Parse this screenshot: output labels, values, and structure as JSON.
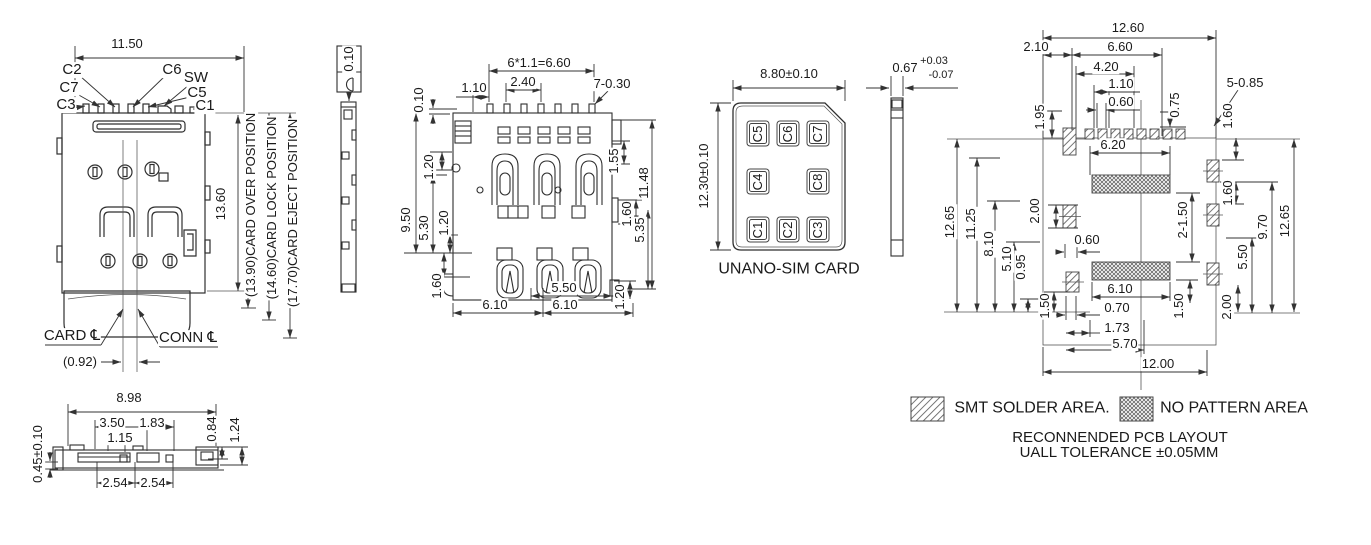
{
  "front": {
    "dim_width": "11.50",
    "dim_height": "13.60",
    "pins": [
      "C2",
      "C7",
      "C3",
      "C6",
      "SW",
      "C5",
      "C1"
    ],
    "positions": [
      "(13.90)CARD OVER POSITION",
      "(14.60)CARD LOCK POSITION",
      "(17.70)CARD EJECT POSITION"
    ],
    "card_cl": "CARD ℄",
    "conn_cl": "CONN ℄",
    "center_offset": "(0.92)"
  },
  "side": {
    "width": "8.98",
    "d_350": "3.50",
    "d_183": "1.83",
    "d_115": "1.15",
    "d_084": "0.84",
    "d_124": "1.24",
    "height_tol": "0.45±0.10",
    "pitch_a": "2.54",
    "pitch_b": "2.54"
  },
  "edge": {
    "profile_tol": "0.10"
  },
  "top": {
    "pin_pitch": "6*1.1=6.60",
    "d_110": "1.10",
    "d_240": "2.40",
    "d_730": "7-0.30",
    "d_010": "0.10",
    "d_120a": "1.20",
    "d_950": "9.50",
    "d_530": "5.30",
    "d_120b": "1.20",
    "d_160a": "1.60",
    "d_550": "5.50",
    "d_610a": "6.10",
    "d_610b": "6.10",
    "d_155": "1.55",
    "d_1148": "11.48",
    "d_160b": "1.60",
    "d_535": "5.35",
    "d_120c": "1.20"
  },
  "sim": {
    "dim_width": "8.80±0.10",
    "dim_height": "12.30±0.10",
    "caption": "UNANO-SIM CARD",
    "pads": [
      "C5",
      "C6",
      "C7",
      "C4",
      "C8",
      "C1",
      "C2",
      "C3"
    ]
  },
  "card_edge": {
    "thickness": "0.67",
    "tol_plus": "+0.03",
    "tol_minus": "-0.07"
  },
  "pcb": {
    "d_1260": "12.60",
    "d_210": "2.10",
    "d_660": "6.60",
    "d_420": "4.20",
    "d_110": "1.10",
    "d_060a": "0.60",
    "d_075": "0.75",
    "d_5085": "5-0.85",
    "d_195": "1.95",
    "d_160a": "1.60",
    "d_620": "6.20",
    "d_200a": "2.00",
    "d_060b": "0.60",
    "d_1265a": "12.65",
    "d_1125": "11.25",
    "d_810": "8.10",
    "d_510": "5.10",
    "d_095": "0.95",
    "d_150a": "1.50",
    "d_2150": "2-1.50",
    "d_150b": "1.50",
    "d_610": "6.10",
    "d_070": "0.70",
    "d_173": "1.73",
    "d_570": "5.70",
    "d_1200": "12.00",
    "d_160b": "1.60",
    "d_970": "9.70",
    "d_1265b": "12.65",
    "d_550": "5.50",
    "d_200b": "2.00"
  },
  "legend": {
    "smt": "SMT SOLDER AREA.",
    "no_pattern": "NO PATTERN AREA",
    "note1": "RECONNENDED PCB LAYOUT",
    "note2": "UALL TOLERANCE ±0.05MM"
  }
}
